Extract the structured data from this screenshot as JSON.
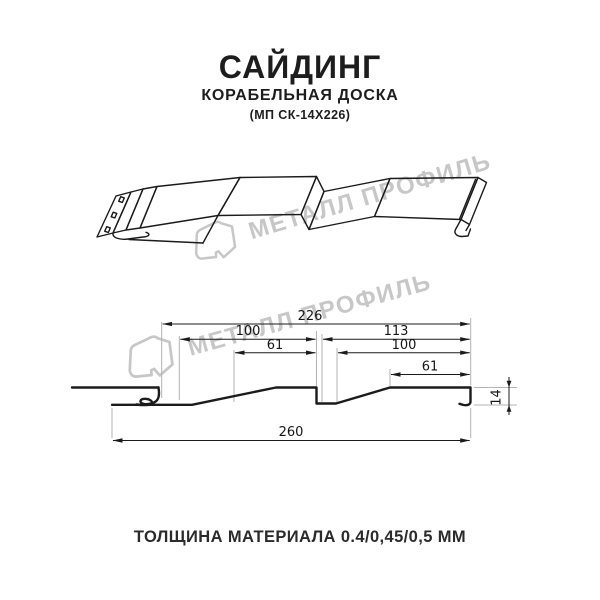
{
  "page": {
    "background": "#ffffff"
  },
  "colors": {
    "line": "#1b1b1b",
    "dimension_line": "#1b1b1b",
    "extension_line": "#b3b3b3",
    "watermark": "#c7c7c7",
    "text": "#1d1d1d"
  },
  "header": {
    "title": "САЙДИНГ",
    "subtitle": "КОРАБЕЛЬНАЯ ДОСКА",
    "model_code": "(МП СК-14Х226)"
  },
  "watermark": {
    "text": "МЕТАЛЛ ПРОФИЛЬ",
    "logo": "metall-profil-logo"
  },
  "cross_section": {
    "dimensions": {
      "top_width": "226",
      "left_panel": "100",
      "right_panel": "113",
      "left_flat": "61",
      "right_inner": "100",
      "right_flat": "61",
      "profile_height": "14",
      "total_width": "260"
    }
  },
  "footer": {
    "material_thickness": "ТОЛЩИНА МАТЕРИАЛА 0.4/0,45/0,5 ММ"
  }
}
